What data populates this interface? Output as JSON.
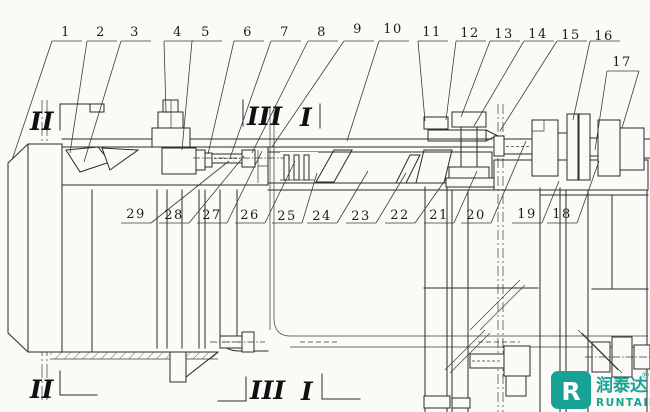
{
  "drawing": {
    "top_callouts": [
      "1",
      "2",
      "3",
      "4",
      "5",
      "6",
      "7",
      "8",
      "9",
      "10",
      "11",
      "12",
      "13",
      "14",
      "15",
      "16",
      "17"
    ],
    "mid_callouts": [
      "29",
      "28",
      "27",
      "26",
      "25",
      "24",
      "23",
      "22",
      "21",
      "20",
      "19",
      "18"
    ],
    "sections": {
      "top_left": "II",
      "top_mid_a": "III",
      "top_mid_b": "I",
      "bottom_left": "II",
      "bottom_mid_a": "III",
      "bottom_mid_b": "I"
    }
  },
  "logo": {
    "icon_letter": "R",
    "cn": "润泰达",
    "reg": "®",
    "en": "RUNTAIDA",
    "teal": "#17a295"
  }
}
